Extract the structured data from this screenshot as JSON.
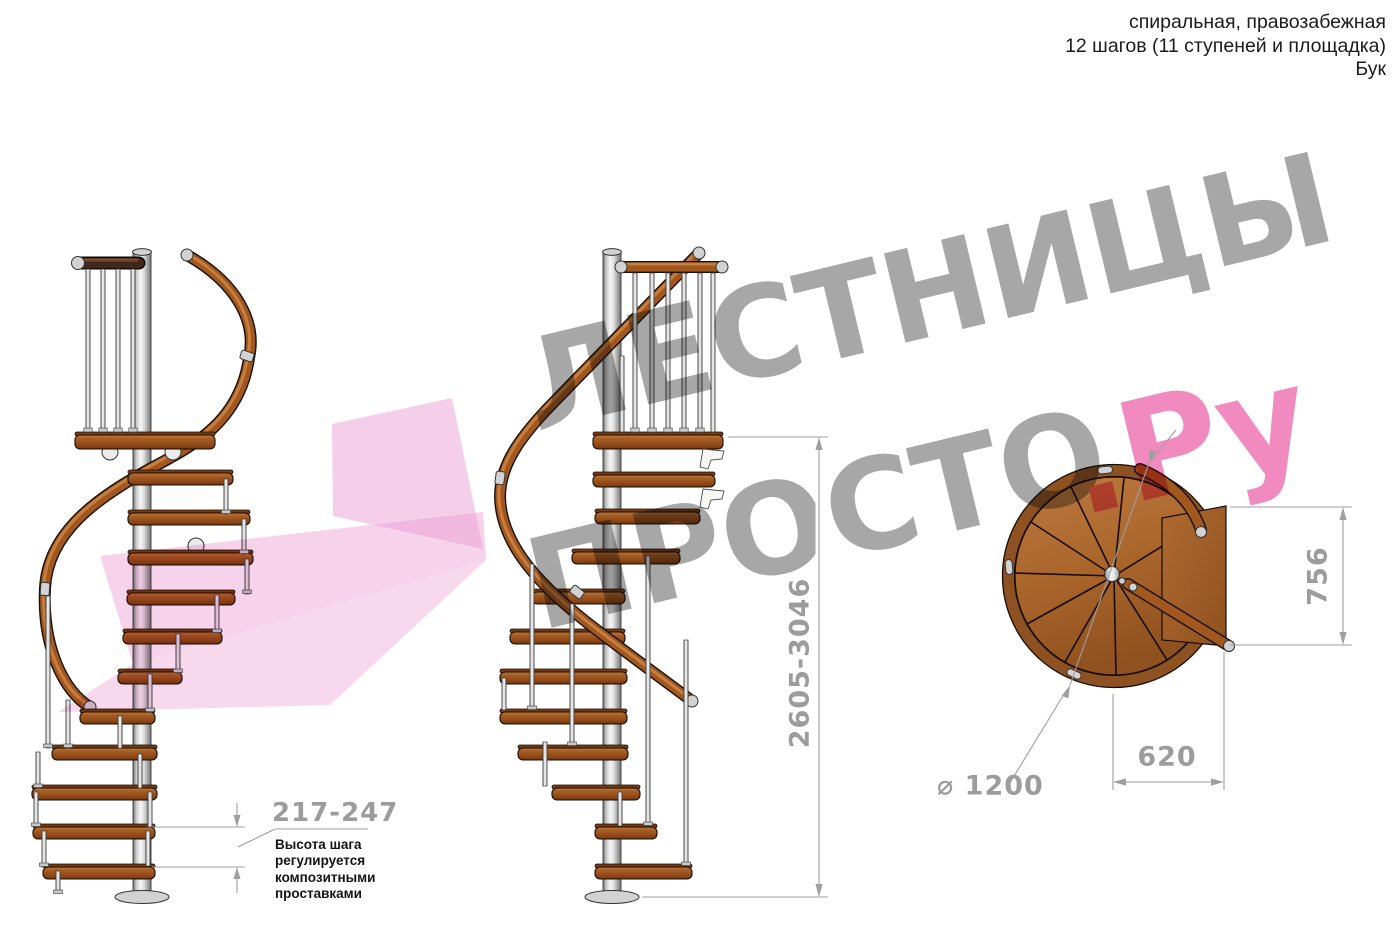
{
  "header": {
    "line1": "спиральная, правозабежная",
    "line2": "12 шагов (11 ступеней и площадка)",
    "line3": "Бук"
  },
  "watermark": {
    "line1": "ЛЕСТНИЦЫ",
    "line2": "ПРОСТО",
    "suffix": ".Ру"
  },
  "annotations": {
    "step_height": {
      "value": "217-247",
      "note_lines": [
        "Высота шага",
        "регулируется",
        "композитными",
        "проставками"
      ]
    },
    "total_height": {
      "value": "2605-3046"
    },
    "platform_depth": {
      "value": "756"
    },
    "tread_width": {
      "value": "620"
    },
    "diameter": {
      "value": "⌀ 1200"
    }
  },
  "colors": {
    "wood": "#a9642a",
    "handrail": "#a1571e",
    "pole": "#cfcfcf",
    "dimension_gray": "#9f9f9f",
    "watermark_gray": "#979797",
    "watermark_pink": "#f07ab5",
    "arrow_pink": "#ec9ed3"
  }
}
